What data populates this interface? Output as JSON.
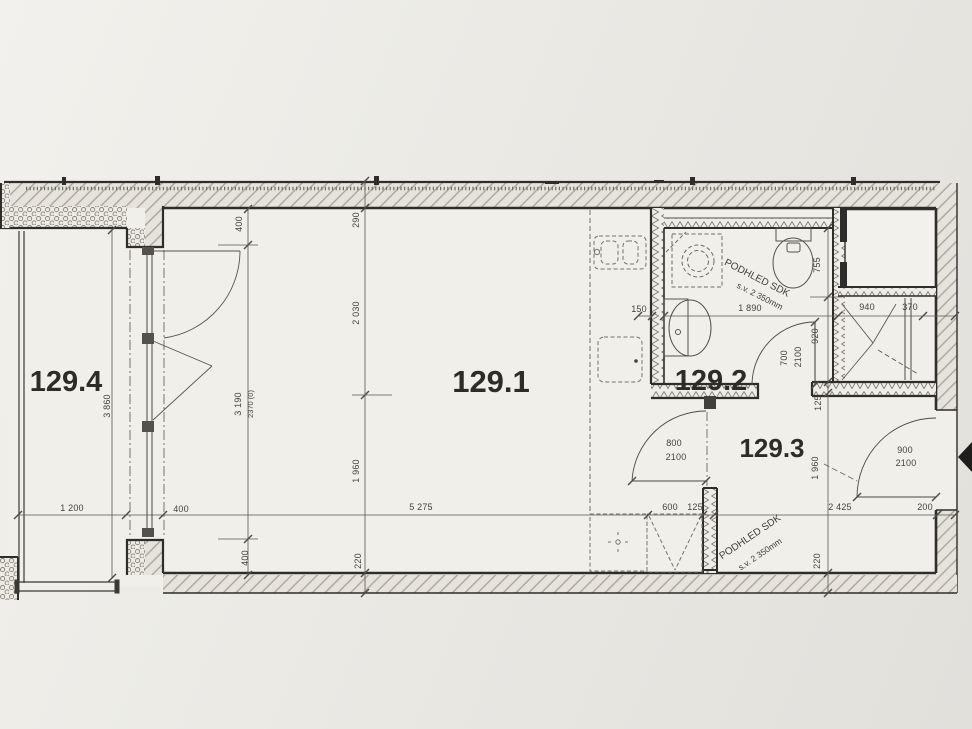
{
  "rooms": {
    "living": {
      "label": "129.1"
    },
    "bathroom": {
      "label": "129.2"
    },
    "hall": {
      "label": "129.3"
    },
    "balcony": {
      "label": "129.4"
    }
  },
  "ceiling_notes": {
    "bathroom": {
      "line1": "PODHLED SDK",
      "line2": "s.v. 2 350mm"
    },
    "hall": {
      "line1": "PODHLED SDK",
      "line2": "s.v. 2 350mm"
    }
  },
  "dims": {
    "v400_top": "400",
    "v290": "290",
    "v2030": "2 030",
    "v3190": "3 190",
    "v2370": "2370 (0)",
    "v3860": "3 860",
    "h1200": "1 200",
    "h400": "400",
    "v400_bottom": "400",
    "h5275": "5 275",
    "v1960_left": "1 960",
    "v220_left": "220",
    "h150": "150",
    "h1890": "1 890",
    "h940": "940",
    "h370": "370",
    "v755": "755",
    "v920": "920",
    "v125": "125",
    "bath_door_w": "700",
    "bath_door_h": "2100",
    "hall_door_w": "800",
    "hall_door_h": "2100",
    "entry_door_w": "900",
    "entry_door_h": "2100",
    "h600": "600",
    "h125": "125",
    "v1960_right": "1 960",
    "v220_right": "220",
    "h2425": "2 425",
    "h200": "200"
  },
  "fixtures": [
    "kitchen-sink",
    "cooktop",
    "washing-machine",
    "reserved-appliance",
    "shower",
    "toilet",
    "washbasin",
    "folding-wardrobe-door",
    "tilt-turn-window",
    "entrance-arrow"
  ],
  "colors": {
    "paper": "#e9e7e2",
    "room": "#f1efe9",
    "ink": "#2e2d29",
    "dim_line": "#56534d",
    "hatch": "#a7a197"
  }
}
